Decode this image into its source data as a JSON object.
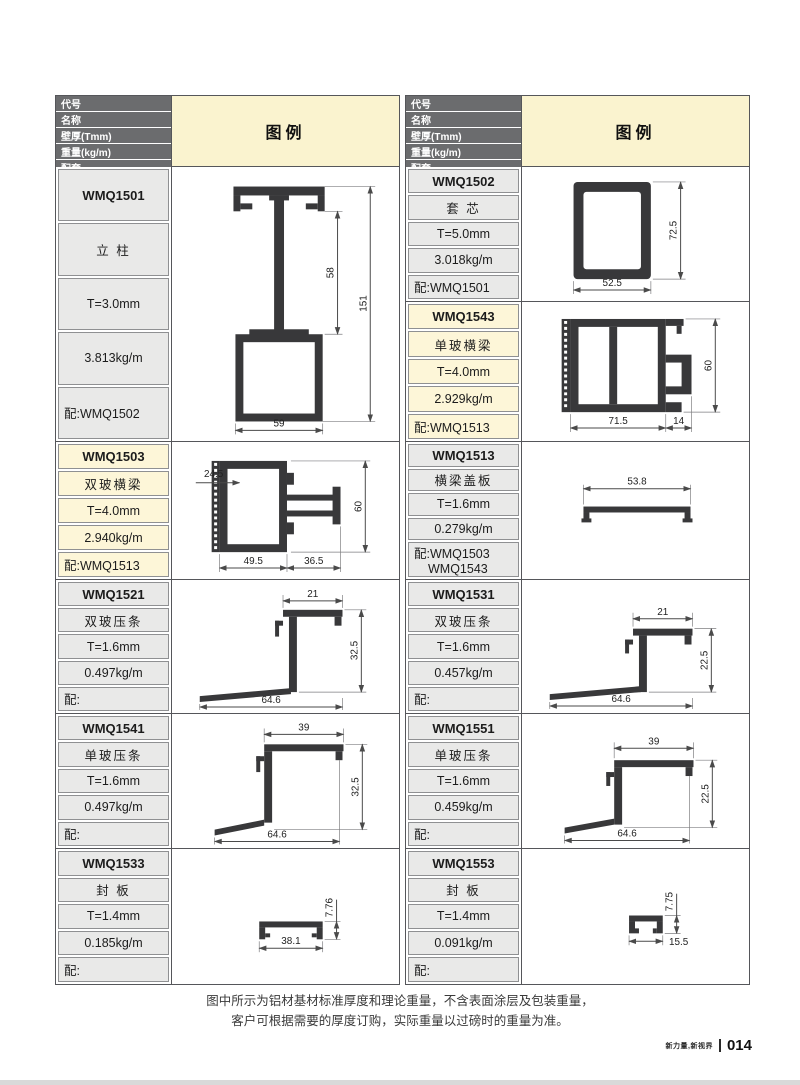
{
  "table_header": {
    "col1": "代号",
    "col2": "名称",
    "col3": "壁厚(Tmm)",
    "col4": "重量(kg/m)",
    "col5": "配套",
    "legend": "图例"
  },
  "profiles": {
    "p1501": {
      "code": "WMQ1501",
      "name": "立 柱",
      "thickness": "T=3.0mm",
      "weight": "3.813kg/m",
      "match": "配:WMQ1502",
      "d1": "58",
      "d2": "151",
      "d3": "59"
    },
    "p1502": {
      "code": "WMQ1502",
      "name": "套 芯",
      "thickness": "T=5.0mm",
      "weight": "3.018kg/m",
      "match": "配:WMQ1501",
      "d1": "72.5",
      "d2": "52.5"
    },
    "p1543": {
      "code": "WMQ1543",
      "name": "单玻横梁",
      "thickness": "T=4.0mm",
      "weight": "2.929kg/m",
      "match": "配:WMQ1513",
      "d1": "60",
      "d2": "71.5",
      "d3": "14"
    },
    "p1503": {
      "code": "WMQ1503",
      "name": "双玻横梁",
      "thickness": "T=4.0mm",
      "weight": "2.940kg/m",
      "match": "配:WMQ1513",
      "d1": "24.5",
      "d2": "60",
      "d3": "49.5",
      "d4": "36.5"
    },
    "p1513": {
      "code": "WMQ1513",
      "name": "横梁盖板",
      "thickness": "T=1.6mm",
      "weight": "0.279kg/m",
      "match": "配:WMQ1503",
      "match2": "WMQ1543",
      "d1": "53.8"
    },
    "p1521": {
      "code": "WMQ1521",
      "name": "双玻压条",
      "thickness": "T=1.6mm",
      "weight": "0.497kg/m",
      "match": "配:",
      "d1": "21",
      "d2": "32.5",
      "d3": "64.6"
    },
    "p1531": {
      "code": "WMQ1531",
      "name": "双玻压条",
      "thickness": "T=1.6mm",
      "weight": "0.457kg/m",
      "match": "配:",
      "d1": "21",
      "d2": "22.5",
      "d3": "64.6"
    },
    "p1541": {
      "code": "WMQ1541",
      "name": "单玻压条",
      "thickness": "T=1.6mm",
      "weight": "0.497kg/m",
      "match": "配:",
      "d1": "39",
      "d2": "32.5",
      "d3": "64.6"
    },
    "p1551": {
      "code": "WMQ1551",
      "name": "单玻压条",
      "thickness": "T=1.6mm",
      "weight": "0.459kg/m",
      "match": "配:",
      "d1": "39",
      "d2": "22.5",
      "d3": "64.6"
    },
    "p1533": {
      "code": "WMQ1533",
      "name": "封 板",
      "thickness": "T=1.4mm",
      "weight": "0.185kg/m",
      "match": "配:",
      "d1": "7.76",
      "d2": "38.1"
    },
    "p1553": {
      "code": "WMQ1553",
      "name": "封 板",
      "thickness": "T=1.4mm",
      "weight": "0.091kg/m",
      "match": "配:",
      "d1": "7.75",
      "d2": "15.5"
    }
  },
  "note": {
    "line1": "图中所示为铝材基材标准厚度和理论重量，不含表面涂层及包装重量，",
    "line2": "客户可根据需要的厚度订购，实际重量以过磅时的重量为准。"
  },
  "footer": {
    "slogan": "新力量,新视界",
    "page": "014"
  },
  "colors": {
    "header_bg": "#6b6c6e",
    "legend_bg": "#faf3cf",
    "cell_bg": "#e9e9e8",
    "highlight_bg": "#fdf6d8"
  }
}
